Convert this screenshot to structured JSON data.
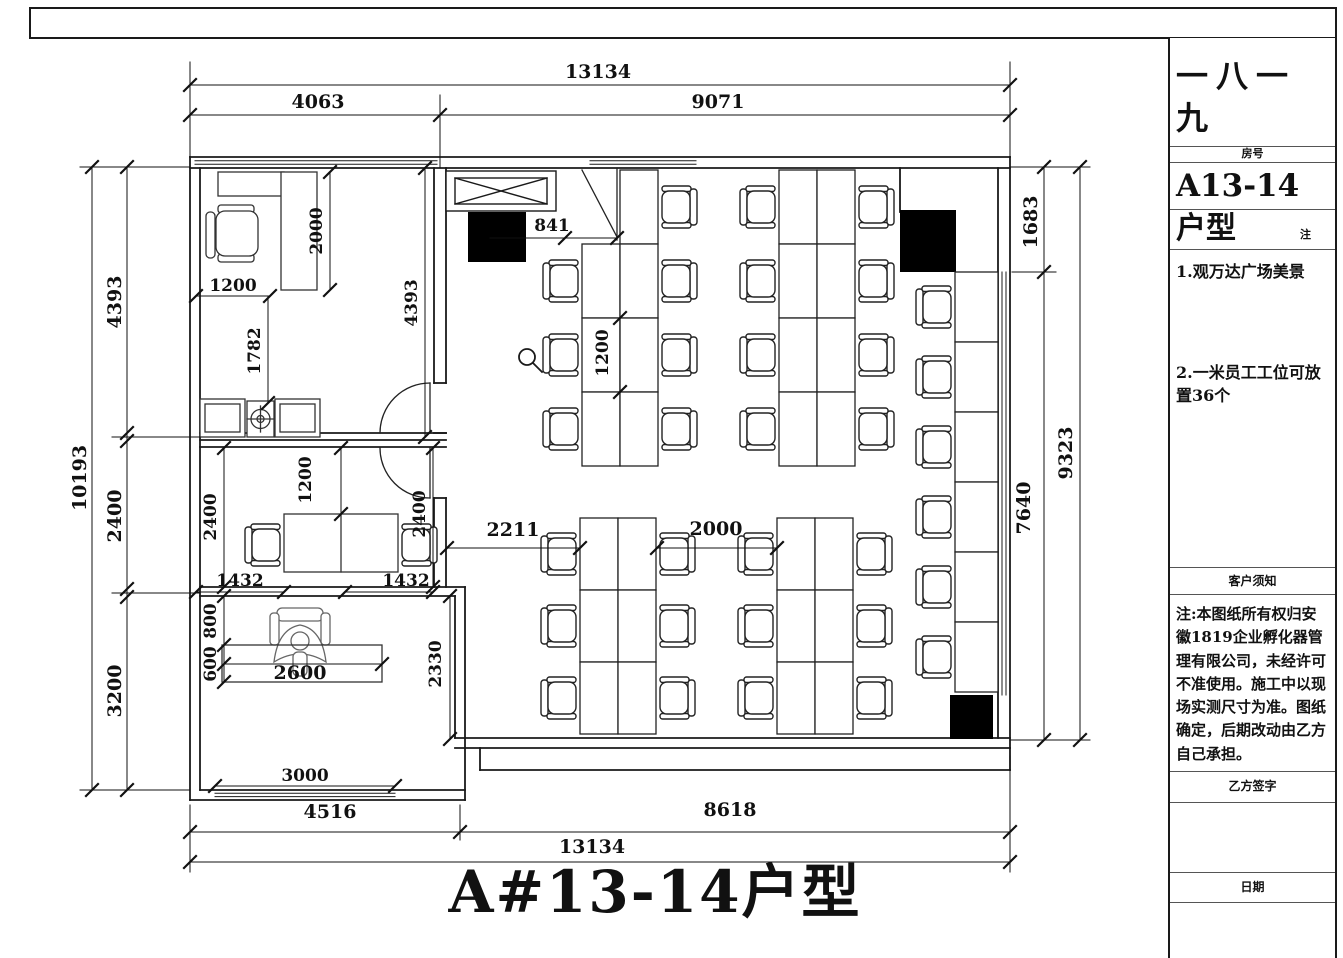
{
  "drawing": {
    "plan_title": "A#13-14户型",
    "dimensions": {
      "top_total": "13134",
      "top_left": "4063",
      "top_right": "9071",
      "left_total": "10193",
      "left_upper": "4393",
      "left_middle": "2400",
      "left_lower": "3200",
      "right_upper": "1683",
      "right_lower": "7640",
      "right_total": "9323",
      "bottom_left": "4516",
      "bottom_right": "8618",
      "bottom_total": "13134",
      "bottom_window": "3000",
      "entry_door": "841",
      "office_desk_pitch": "1200",
      "office_gap_left": "2211",
      "office_gap_right": "2000",
      "room1_desk_return": "2000",
      "room1_desk_width": "1200",
      "room1_sofa_offset": "1782",
      "room1_height": "4393",
      "meeting_left": "2400",
      "meeting_table": "1200",
      "meeting_right": "2400",
      "meeting_bottom_left": "1432",
      "meeting_bottom_right": "1432",
      "exec_clear": "800",
      "exec_desk_depth": "600",
      "exec_desk_length": "2600",
      "exec_corridor": "2330"
    },
    "desk_banks": [
      {
        "x": 582,
        "y": 170,
        "cols": 2,
        "rows": 4,
        "cw": 38,
        "rh": 74,
        "skip": [
          [
            0,
            0
          ]
        ],
        "left": [
          1,
          2,
          3
        ],
        "right": [
          0,
          1,
          2,
          3
        ]
      },
      {
        "x": 779,
        "y": 170,
        "cols": 2,
        "rows": 4,
        "cw": 38,
        "rh": 74,
        "skip": [],
        "left": [
          0,
          1,
          2,
          3
        ],
        "right": [
          0,
          1,
          2,
          3
        ]
      },
      {
        "x": 955,
        "y": 272,
        "cols": 1,
        "rows": 6,
        "cw": 43,
        "rh": 70,
        "skip": [],
        "left": [
          0,
          1,
          2,
          3,
          4,
          5
        ],
        "right": []
      },
      {
        "x": 580,
        "y": 518,
        "cols": 2,
        "rows": 3,
        "cw": 38,
        "rh": 72,
        "skip": [],
        "left": [
          0,
          1,
          2
        ],
        "right": [
          0,
          1,
          2
        ]
      },
      {
        "x": 777,
        "y": 518,
        "cols": 2,
        "rows": 3,
        "cw": 38,
        "rh": 72,
        "skip": [],
        "left": [
          0,
          1,
          2
        ],
        "right": [
          0,
          1,
          2
        ]
      }
    ]
  },
  "title_block": {
    "project_name": "一八一九",
    "room_no_label": "房号",
    "room_no": "A13-14",
    "unit_label": "户型",
    "note_label": "注",
    "note_1": "1.观万达广场美景",
    "note_2": "2.一米员工工位可放置36个",
    "customer_notice_label": "客户须知",
    "customer_notice": "注:本图纸所有权归安徽1819企业孵化器管理有限公司，未经许可不准使用。施工中以现场实测尺寸为准。图纸确定，后期改动由乙方自己承担。",
    "party_b_label": "乙方签字",
    "date_label": "日期"
  },
  "colors": {
    "line": "#1a1a1a",
    "background": "#ffffff"
  }
}
